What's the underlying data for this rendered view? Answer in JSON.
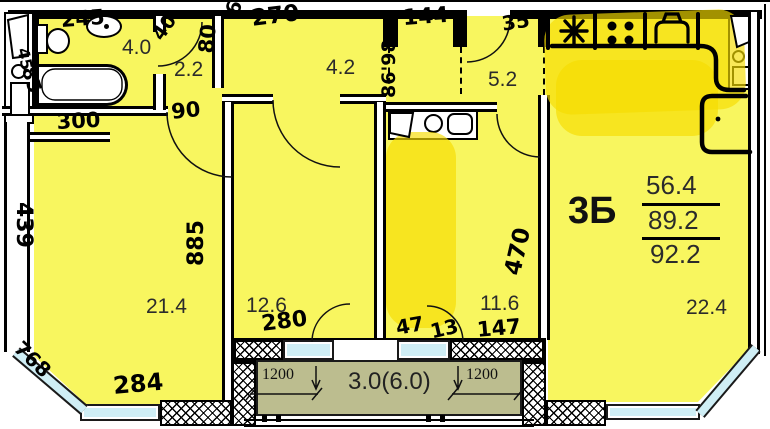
{
  "apartment": {
    "type_label": "3Б",
    "area_living": "56.4",
    "area_total": "89.2",
    "area_full": "92.2"
  },
  "rooms": {
    "bathroom": "4.0",
    "wc_hall": "2.2",
    "hallway": "4.2",
    "entry_hall": "5.2",
    "room_middle": "12.6",
    "room_right": "11.6",
    "room_left": "21.4",
    "kitchen_living": "22.4"
  },
  "balcony": {
    "label": "3.0(6.0)",
    "dim_left": "1200",
    "dim_right": "1200"
  },
  "handwritten": {
    "w245": "245",
    "w45": "45",
    "w85": "85",
    "w40": "40",
    "w300": "300",
    "w90": "90",
    "w80": "80",
    "w61": "61",
    "w270": "270",
    "w144": "144",
    "w8698": "86'98",
    "w35": "35",
    "w439": "439",
    "w885": "885",
    "w768": "768",
    "w284": "284",
    "w280": "280",
    "w47": "47",
    "w13": "13",
    "w147": "147",
    "w470": "470"
  },
  "colors": {
    "room_fill": "#f8f65f",
    "highlight": "#f6dc00",
    "glass": "#cfeef5",
    "balcony_floor": "#bcbd8f",
    "wall": "#000000"
  }
}
